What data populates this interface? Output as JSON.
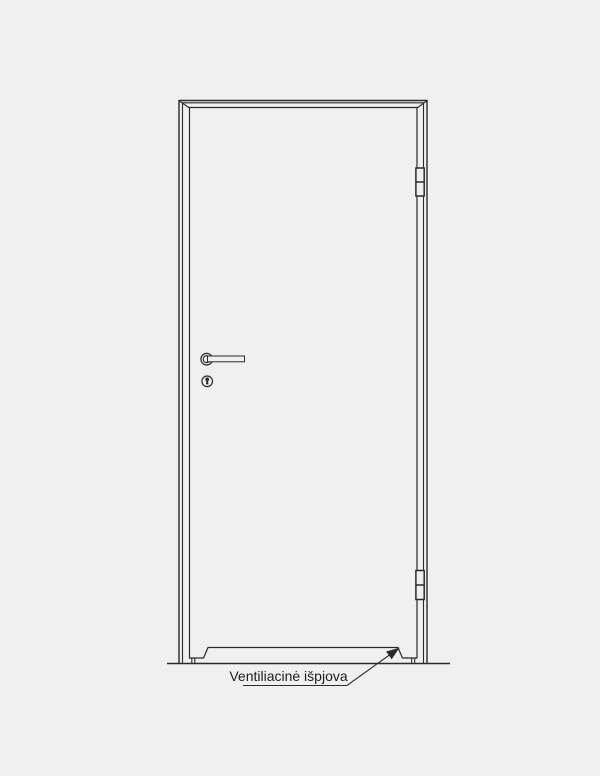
{
  "colors": {
    "background": "#f0f0f0",
    "line": "#2a2a2a",
    "text": "#1c1c1c"
  },
  "diagram": {
    "kind": "door elevation technical drawing",
    "callout_label": "Ventiliacinė išpjova",
    "element_names": [
      "floor-line",
      "door-frame",
      "door-leaf",
      "ventilation-cutout",
      "top-hinge",
      "bottom-hinge",
      "lever-handle",
      "keyhole",
      "leader-arrow"
    ]
  }
}
